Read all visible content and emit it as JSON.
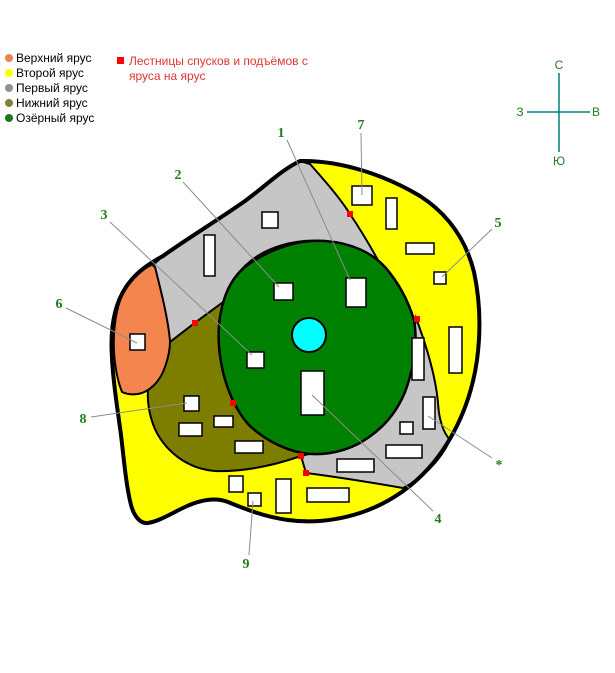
{
  "legend": {
    "tiers": [
      {
        "label": "Верхний ярус",
        "color": "#E8824E"
      },
      {
        "label": "Второй ярус",
        "color": "#FFFF00"
      },
      {
        "label": "Первый ярус",
        "color": "#909090"
      },
      {
        "label": "Нижний ярус",
        "color": "#808040"
      },
      {
        "label": "Озёрный ярус",
        "color": "#1A7A1A"
      }
    ],
    "stairs": {
      "line1": "Лестницы спусков и подъёмов с",
      "line2": "яруса на ярус",
      "text_color": "#E03535",
      "marker_color": "#FF0000"
    }
  },
  "compass": {
    "north": "С",
    "south": "Ю",
    "west": "З",
    "east": "В"
  },
  "map": {
    "labels": [
      {
        "text": "1"
      },
      {
        "text": "2"
      },
      {
        "text": "3"
      },
      {
        "text": "4"
      },
      {
        "text": "5"
      },
      {
        "text": "6"
      },
      {
        "text": "7"
      },
      {
        "text": "8"
      },
      {
        "text": "9"
      },
      {
        "text": "*"
      }
    ]
  },
  "colors": {
    "tier_upper": "#F5854F",
    "tier_second": "#FFFF00",
    "tier_first": "#C6C6C6",
    "tier_lower": "#7D7D00",
    "tier_lake_ring": "#008000",
    "lake": "#00FFFF",
    "stairs": "#FF0000",
    "label": "#1E7D1E",
    "leader": "#8C8C8C",
    "compass_line": "#008080"
  }
}
